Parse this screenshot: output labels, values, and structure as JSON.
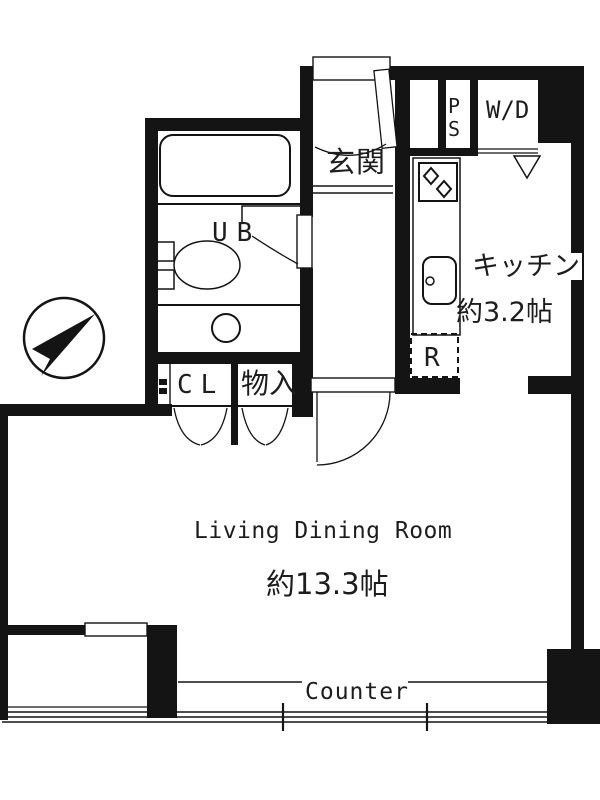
{
  "plan": {
    "bg_color": "#ffffff",
    "line_color": "#141414"
  },
  "rooms": {
    "entrance": {
      "label": "玄関"
    },
    "unit_bath": {
      "label": "UB"
    },
    "closet": {
      "label": "CL"
    },
    "storage": {
      "label": "物入"
    },
    "kitchen": {
      "label": "キッチン",
      "size": "約3.2帖"
    },
    "living": {
      "label": "Living Dining Room",
      "size": "約13.3帖"
    }
  },
  "fixtures": {
    "pipe_space": {
      "line1": "P",
      "line2": "S"
    },
    "washer_dryer": {
      "label": "W/D"
    },
    "refrigerator": {
      "label": "R"
    },
    "counter": {
      "label": "Counter"
    }
  }
}
